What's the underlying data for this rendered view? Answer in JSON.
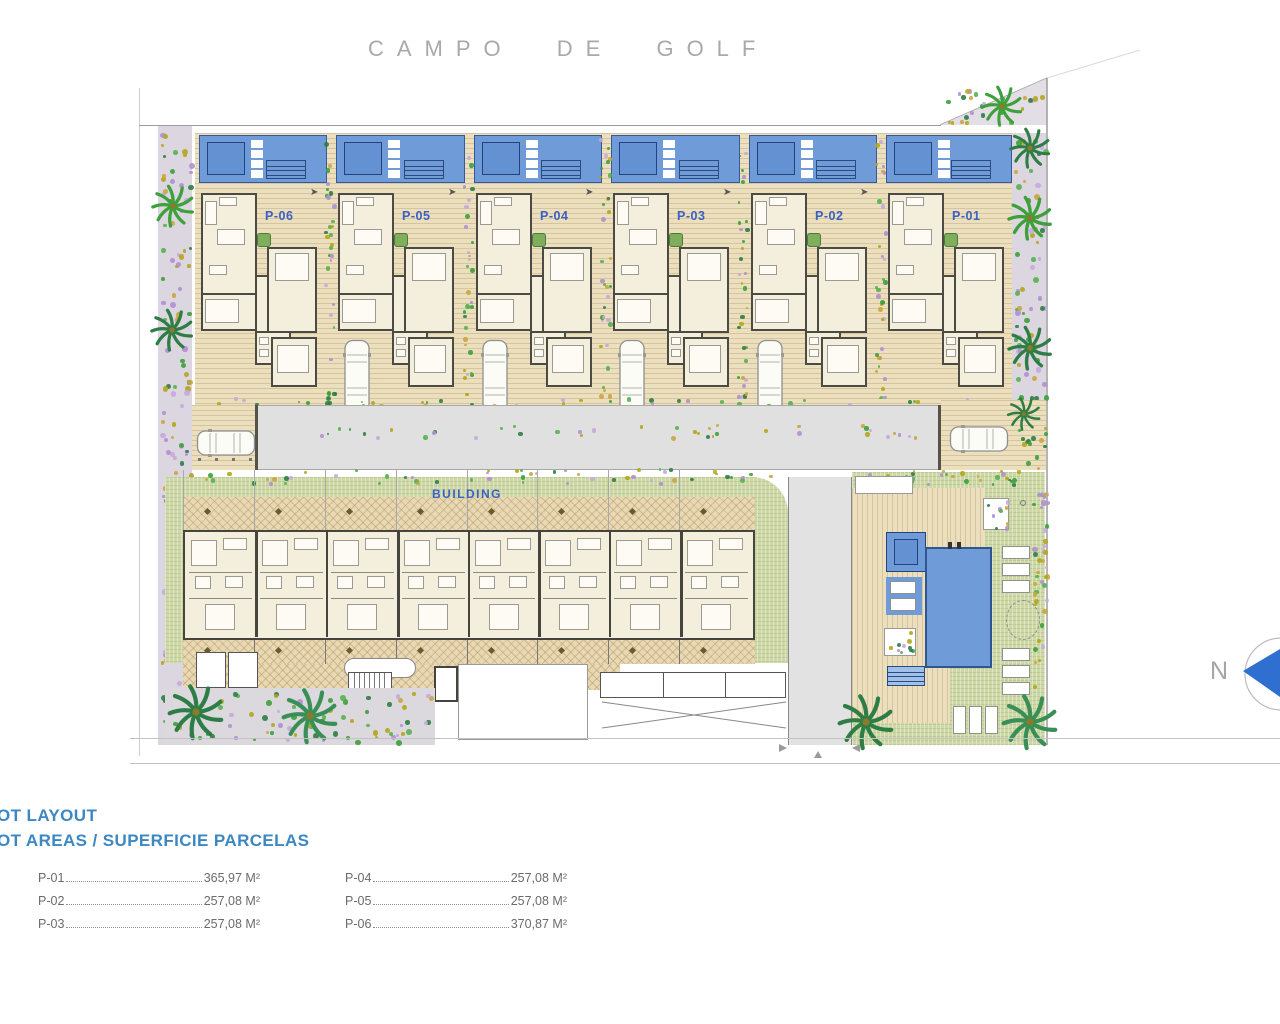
{
  "title": "CAMPO DE GOLF",
  "building": {
    "label": "BUILDING"
  },
  "compass": {
    "label": "N"
  },
  "plots": [
    {
      "id": "P-06",
      "label": "P-06",
      "car_in_driveway": false
    },
    {
      "id": "P-05",
      "label": "P-05",
      "car_in_driveway": true
    },
    {
      "id": "P-04",
      "label": "P-04",
      "car_in_driveway": true
    },
    {
      "id": "P-03",
      "label": "P-03",
      "car_in_driveway": true
    },
    {
      "id": "P-02",
      "label": "P-02",
      "car_in_driveway": true
    },
    {
      "id": "P-01",
      "label": "P-01",
      "car_in_driveway": false
    }
  ],
  "footer": {
    "heading1": "OT LAYOUT",
    "heading2": "OT AREAS / SUPERFICIE PARCELAS",
    "areas_table": {
      "left_column": [
        {
          "plot": "P-01",
          "area": "365,97 M²"
        },
        {
          "plot": "P-02",
          "area": "257,08 M²"
        },
        {
          "plot": "P-03",
          "area": "257,08 M²"
        }
      ],
      "right_column": [
        {
          "plot": "P-04",
          "area": "257,08 M²"
        },
        {
          "plot": "P-05",
          "area": "257,08 M²"
        },
        {
          "plot": "P-06",
          "area": "370,87 M²"
        }
      ]
    }
  },
  "colors": {
    "pool_blue": "#6f9cd9",
    "pool_border": "#2f568f",
    "deck_beige": "#ecdfbd",
    "house_wall": "#4b4b44",
    "house_fill": "#f4eedd",
    "label_blue": "#3b5fc5",
    "heading_blue": "#3d87c2",
    "road_gray": "#e0e0e0",
    "lawn_green": "#cdd8a6",
    "garden_violet": "#dcd6e0",
    "bush_green": "#3da03a",
    "bush_olive": "#b3a61c",
    "flower_violet": "#c7a8dd",
    "compass_blue": "#2e6fd0",
    "title_gray": "#a9a9a9",
    "table_gray": "#6b6b6b"
  }
}
